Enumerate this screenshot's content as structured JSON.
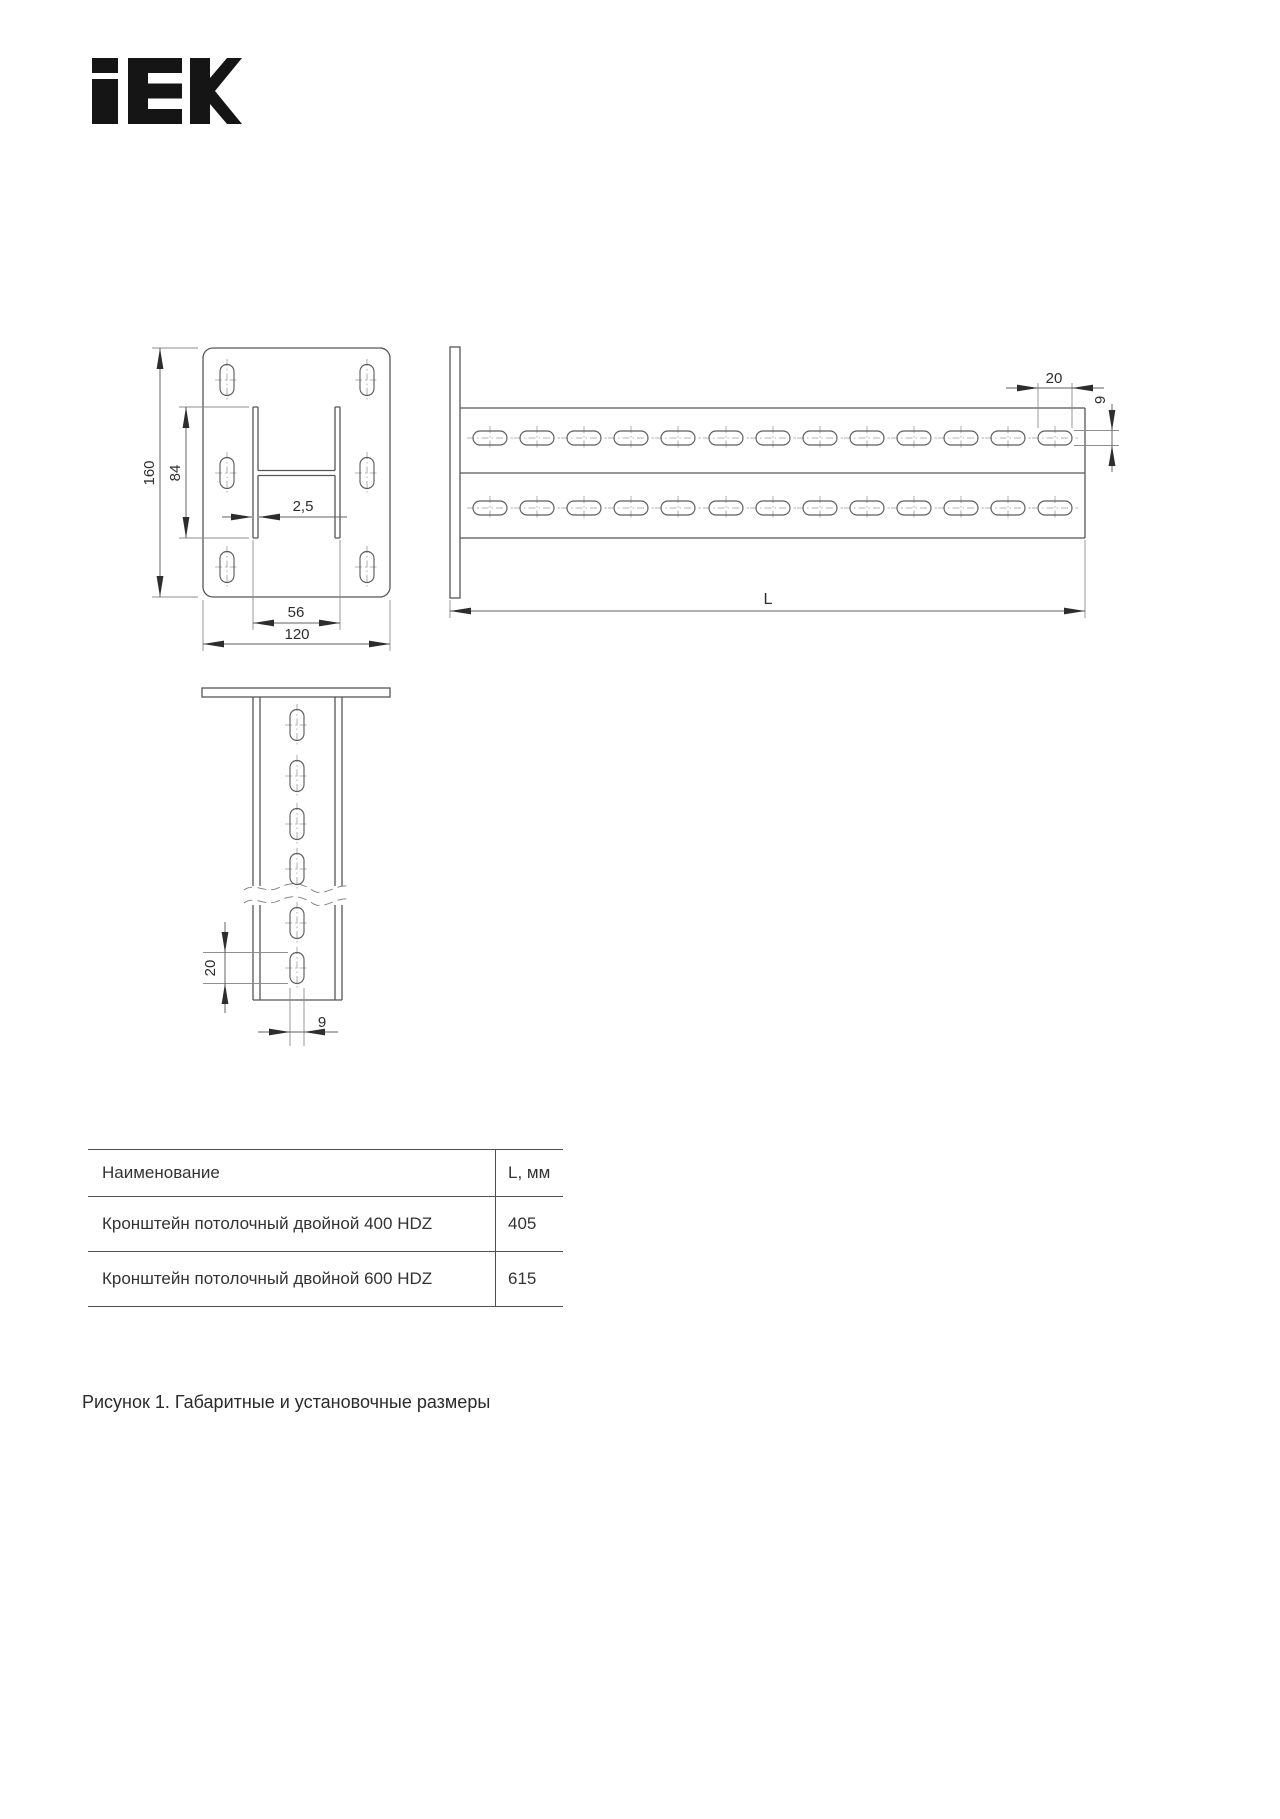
{
  "logo": {
    "text": "IEK"
  },
  "figure": {
    "front_view": {
      "height": "160",
      "profile_height": "84",
      "thickness": "2,5",
      "profile_width": "56",
      "plate_width": "120"
    },
    "side_view": {
      "slot_length": "20",
      "slot_width": "9",
      "length": "L"
    },
    "column_view": {
      "slot_length": "20",
      "slot_width": "9"
    }
  },
  "table": {
    "headers": {
      "name": "Наименование",
      "length": "L, мм"
    },
    "rows": [
      {
        "name": "Кронштейн потолочный двойной 400 HDZ",
        "length": "405"
      },
      {
        "name": "Кронштейн потолочный двойной 600 HDZ",
        "length": "615"
      }
    ]
  },
  "caption": "Рисунок 1. Габаритные и установочные размеры"
}
